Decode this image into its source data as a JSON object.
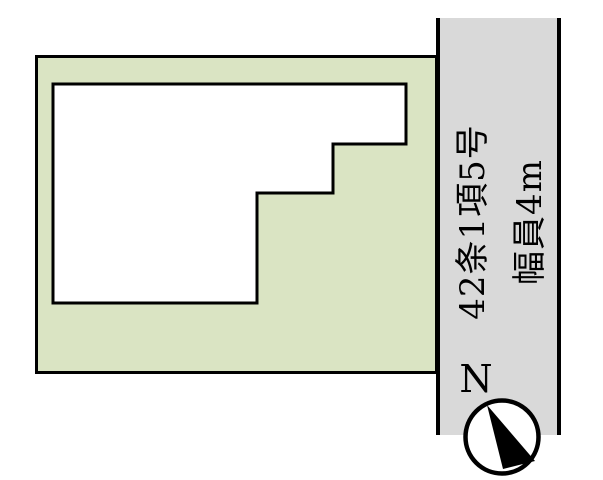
{
  "canvas": {
    "width": 603,
    "height": 480,
    "background": "#ffffff"
  },
  "road": {
    "label_line1": "42条1項5号",
    "label_line2": "幅員4m",
    "fill": "#d9d9d9",
    "edge_color": "#000000",
    "label_color": "#000000"
  },
  "plot": {
    "fill": "#dae4c3",
    "outline_color": "#000000"
  },
  "building": {
    "fill": "#ffffff",
    "outline_color": "#000000"
  },
  "compass": {
    "north_label": "N",
    "label_color": "#000000",
    "ring_color": "#000000",
    "face_color": "#ffffff",
    "needle_color": "#000000"
  }
}
